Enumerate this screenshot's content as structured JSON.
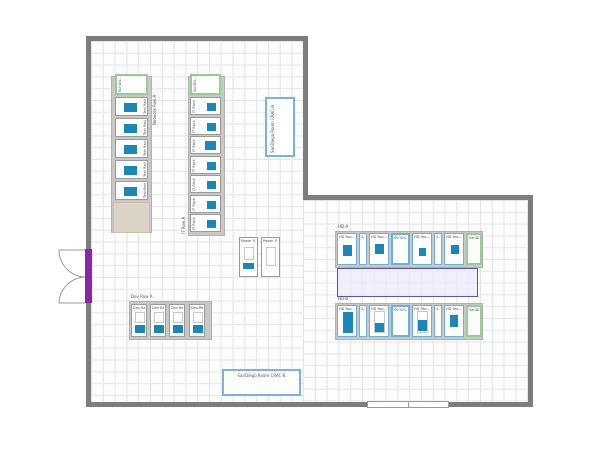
{
  "app": {
    "view_description": "Data center room floor plan canvas"
  },
  "colors": {
    "wall": "#7d7d7d",
    "grid_line": "#e3e3ec",
    "rack_fill_teal": "#1d86b4",
    "rack_border_blue": "#6fb0da",
    "rack_border_green": "#93cf92",
    "container_gray": "#cac8c4",
    "spacer_beige": "#d9d4c6",
    "aisle_fill": "#eceafa",
    "aisle_border": "#5a56a8",
    "door_purple": "#8e24aa"
  },
  "floorplan": {
    "row_labels": [
      {
        "text": "Network Row A",
        "x": 152,
        "y": 79,
        "vert": true,
        "h": 46
      },
      {
        "text": "IT Row A",
        "x": 181,
        "y": 206,
        "vert": true,
        "h": 28
      },
      {
        "text": "HD-A",
        "x": 338,
        "y": 224,
        "vert": false,
        "h": 5
      },
      {
        "text": "HD-B",
        "x": 338,
        "y": 296,
        "vert": false,
        "h": 5
      },
      {
        "text": "Dev Row A",
        "x": 131,
        "y": 294,
        "vert": false,
        "h": 5
      }
    ],
    "containers": [
      {
        "x": 111,
        "y": 76,
        "w": 41,
        "h": 157,
        "beige": false
      },
      {
        "x": 113,
        "y": 202,
        "w": 37,
        "h": 31,
        "beige": true
      },
      {
        "x": 188,
        "y": 76,
        "w": 37,
        "h": 160,
        "beige": false
      },
      {
        "x": 335,
        "y": 231,
        "w": 148,
        "h": 37,
        "beige": false
      },
      {
        "x": 335,
        "y": 303,
        "w": 148,
        "h": 37,
        "beige": false
      },
      {
        "x": 129,
        "y": 301,
        "w": 83,
        "h": 39,
        "beige": false
      }
    ],
    "aisle": {
      "x": 337,
      "y": 268,
      "w": 141,
      "h": 29
    },
    "racks": [
      {
        "label": "SunDis...",
        "x": 115,
        "y": 74,
        "w": 33,
        "h": 21,
        "border": "green",
        "lp": "leftv",
        "fills": []
      },
      {
        "label": "Test Rack 1",
        "x": 115,
        "y": 97,
        "w": 33,
        "h": 19,
        "border": "gray",
        "lp": "rightv",
        "fills": [
          {
            "t": "teal",
            "x": 8,
            "y": 5,
            "w": 13,
            "h": 9
          }
        ]
      },
      {
        "label": "Test Rack 2",
        "x": 115,
        "y": 118,
        "w": 33,
        "h": 19,
        "border": "gray",
        "lp": "rightv",
        "fills": [
          {
            "t": "teal",
            "x": 8,
            "y": 5,
            "w": 13,
            "h": 9
          }
        ]
      },
      {
        "label": "Test Rack 3",
        "x": 115,
        "y": 139,
        "w": 33,
        "h": 19,
        "border": "gray",
        "lp": "rightv",
        "fills": [
          {
            "t": "teal",
            "x": 8,
            "y": 5,
            "w": 13,
            "h": 9
          }
        ]
      },
      {
        "label": "Test Rack 4",
        "x": 115,
        "y": 160,
        "w": 33,
        "h": 19,
        "border": "gray",
        "lp": "rightv",
        "fills": [
          {
            "t": "teal",
            "x": 8,
            "y": 5,
            "w": 13,
            "h": 9
          }
        ]
      },
      {
        "label": "Test Rack 5",
        "x": 115,
        "y": 181,
        "w": 33,
        "h": 19,
        "border": "gray",
        "lp": "rightv",
        "fills": [
          {
            "t": "teal",
            "x": 8,
            "y": 5,
            "w": 13,
            "h": 9
          }
        ]
      },
      {
        "label": "SunDis...",
        "x": 190,
        "y": 74,
        "w": 31,
        "h": 21,
        "border": "green",
        "lp": "leftv",
        "fills": []
      },
      {
        "label": "IT Rack 1",
        "x": 190,
        "y": 97,
        "w": 31,
        "h": 18,
        "border": "gray",
        "lp": "leftv",
        "fills": [
          {
            "t": "teal",
            "x": 16,
            "y": 5,
            "w": 9,
            "h": 8
          }
        ]
      },
      {
        "label": "IT Rack 2",
        "x": 190,
        "y": 117,
        "w": 31,
        "h": 18,
        "border": "gray",
        "lp": "leftv",
        "fills": [
          {
            "t": "teal",
            "x": 16,
            "y": 5,
            "w": 9,
            "h": 8
          }
        ]
      },
      {
        "label": "IT Rack 3",
        "x": 190,
        "y": 136,
        "w": 31,
        "h": 18,
        "border": "gray",
        "lp": "leftv",
        "fills": [
          {
            "t": "teal",
            "x": 14,
            "y": 4,
            "w": 11,
            "h": 9
          }
        ]
      },
      {
        "label": "IT Rack 4",
        "x": 190,
        "y": 156,
        "w": 31,
        "h": 18,
        "border": "gray",
        "lp": "leftv",
        "fills": [
          {
            "t": "teal",
            "x": 16,
            "y": 5,
            "w": 9,
            "h": 8
          }
        ]
      },
      {
        "label": "IT Rack 5",
        "x": 190,
        "y": 175,
        "w": 31,
        "h": 18,
        "border": "gray",
        "lp": "leftv",
        "fills": [
          {
            "t": "teal",
            "x": 16,
            "y": 5,
            "w": 9,
            "h": 8
          }
        ]
      },
      {
        "label": "IT Rack 6",
        "x": 190,
        "y": 195,
        "w": 31,
        "h": 18,
        "border": "gray",
        "lp": "leftv",
        "fills": [
          {
            "t": "teal",
            "x": 16,
            "y": 5,
            "w": 9,
            "h": 8
          }
        ]
      },
      {
        "label": "IT Rack 7",
        "x": 190,
        "y": 214,
        "w": 31,
        "h": 18,
        "border": "gray",
        "lp": "leftv",
        "fills": [
          {
            "t": "teal",
            "x": 16,
            "y": 5,
            "w": 9,
            "h": 8
          }
        ]
      },
      {
        "label": "Power P...",
        "x": 239,
        "y": 237,
        "w": 19,
        "h": 40,
        "border": "gray",
        "lp": "top",
        "fills": [
          {
            "t": "outline",
            "x": 4,
            "y": 9,
            "w": 10,
            "h": 13
          },
          {
            "t": "teal",
            "x": 3,
            "y": 25,
            "w": 11,
            "h": 6
          }
        ]
      },
      {
        "label": "Power P...",
        "x": 261,
        "y": 237,
        "w": 19,
        "h": 40,
        "border": "gray",
        "lp": "top",
        "fills": [
          {
            "t": "outline",
            "x": 4,
            "y": 9,
            "w": 10,
            "h": 19
          }
        ]
      },
      {
        "label": "HD Rac...",
        "x": 337,
        "y": 233,
        "w": 20,
        "h": 32,
        "border": "blue",
        "lp": "top",
        "fills": [
          {
            "t": "teal",
            "x": 5,
            "y": 11,
            "w": 9,
            "h": 11
          }
        ]
      },
      {
        "label": "S...",
        "x": 359,
        "y": 233,
        "w": 8,
        "h": 32,
        "border": "blue",
        "lp": "top",
        "fills": []
      },
      {
        "label": "HD Rac...",
        "x": 369,
        "y": 233,
        "w": 20,
        "h": 32,
        "border": "blue",
        "lp": "top",
        "fills": [
          {
            "t": "teal",
            "x": 5,
            "y": 10,
            "w": 9,
            "h": 10
          }
        ]
      },
      {
        "label": "SD Vm...",
        "x": 391,
        "y": 233,
        "w": 19,
        "h": 32,
        "border": "blue2",
        "lp": "top",
        "fills": []
      },
      {
        "label": "HD Rac...",
        "x": 412,
        "y": 233,
        "w": 20,
        "h": 32,
        "border": "blue",
        "lp": "top",
        "fills": [
          {
            "t": "teal",
            "x": 6,
            "y": 14,
            "w": 7,
            "h": 8
          }
        ]
      },
      {
        "label": "S...",
        "x": 434,
        "y": 233,
        "w": 8,
        "h": 32,
        "border": "blue",
        "lp": "top",
        "fills": []
      },
      {
        "label": "HD Rac...",
        "x": 444,
        "y": 233,
        "w": 20,
        "h": 32,
        "border": "blue",
        "lp": "top",
        "fills": [
          {
            "t": "teal",
            "x": 6,
            "y": 11,
            "w": 8,
            "h": 9
          }
        ]
      },
      {
        "label": "SanDiego...",
        "x": 466,
        "y": 233,
        "w": 16,
        "h": 32,
        "border": "green",
        "lp": "top",
        "fills": []
      },
      {
        "label": "HD Rac...",
        "x": 337,
        "y": 305,
        "w": 20,
        "h": 32,
        "border": "blue",
        "lp": "top",
        "fills": [
          {
            "t": "teal",
            "x": 5,
            "y": 6,
            "w": 10,
            "h": 21
          }
        ]
      },
      {
        "label": "S...",
        "x": 359,
        "y": 305,
        "w": 8,
        "h": 32,
        "border": "blue",
        "lp": "top",
        "fills": []
      },
      {
        "label": "HD Rac...",
        "x": 369,
        "y": 305,
        "w": 20,
        "h": 32,
        "border": "blue",
        "lp": "top",
        "fills": [
          {
            "t": "outline",
            "x": 4,
            "y": 5,
            "w": 11,
            "h": 22
          },
          {
            "t": "teal",
            "x": 5,
            "y": 17,
            "w": 9,
            "h": 9
          }
        ]
      },
      {
        "label": "SD Vm...",
        "x": 391,
        "y": 305,
        "w": 19,
        "h": 32,
        "border": "blue2",
        "lp": "top",
        "fills": []
      },
      {
        "label": "HD Rac...",
        "x": 412,
        "y": 305,
        "w": 20,
        "h": 32,
        "border": "blue",
        "lp": "top",
        "fills": [
          {
            "t": "outline",
            "x": 4,
            "y": 5,
            "w": 11,
            "h": 22
          },
          {
            "t": "teal",
            "x": 5,
            "y": 14,
            "w": 9,
            "h": 11
          }
        ]
      },
      {
        "label": "S...",
        "x": 434,
        "y": 305,
        "w": 8,
        "h": 32,
        "border": "blue",
        "lp": "top",
        "fills": []
      },
      {
        "label": "HD Rac...",
        "x": 444,
        "y": 305,
        "w": 20,
        "h": 32,
        "border": "blue",
        "lp": "top",
        "fills": [
          {
            "t": "teal",
            "x": 5,
            "y": 9,
            "w": 8,
            "h": 12
          }
        ]
      },
      {
        "label": "SanDiego...",
        "x": 466,
        "y": 305,
        "w": 16,
        "h": 32,
        "border": "green",
        "lp": "top",
        "fills": []
      },
      {
        "label": "Dev Ra...",
        "x": 131,
        "y": 304,
        "w": 16,
        "h": 33,
        "border": "gray",
        "lp": "top",
        "fills": [
          {
            "t": "outline",
            "x": 3,
            "y": 7,
            "w": 10,
            "h": 11
          },
          {
            "t": "teal",
            "x": 3,
            "y": 20,
            "w": 10,
            "h": 8
          }
        ]
      },
      {
        "label": "Dev Ra...",
        "x": 150,
        "y": 304,
        "w": 16,
        "h": 33,
        "border": "gray",
        "lp": "top",
        "fills": [
          {
            "t": "outline",
            "x": 3,
            "y": 7,
            "w": 10,
            "h": 11
          },
          {
            "t": "teal",
            "x": 3,
            "y": 20,
            "w": 10,
            "h": 8
          }
        ]
      },
      {
        "label": "Dev Ra...",
        "x": 169,
        "y": 304,
        "w": 16,
        "h": 33,
        "border": "gray",
        "lp": "top",
        "fills": [
          {
            "t": "outline",
            "x": 3,
            "y": 7,
            "w": 10,
            "h": 11
          },
          {
            "t": "teal",
            "x": 3,
            "y": 20,
            "w": 10,
            "h": 8
          }
        ]
      },
      {
        "label": "Dev Ra...",
        "x": 189,
        "y": 304,
        "w": 16,
        "h": 33,
        "border": "gray",
        "lp": "top",
        "fills": [
          {
            "t": "outline",
            "x": 3,
            "y": 7,
            "w": 10,
            "h": 11
          },
          {
            "t": "teal",
            "x": 3,
            "y": 20,
            "w": 10,
            "h": 8
          }
        ]
      }
    ],
    "cracs": [
      {
        "label": "SanDiego Room CRAC-A",
        "x": 265,
        "y": 97,
        "w": 30,
        "h": 60,
        "vert": true
      },
      {
        "label": "SanDiego Room CRAC-B",
        "x": 222,
        "y": 369,
        "w": 79,
        "h": 27,
        "vert": false
      }
    ]
  }
}
